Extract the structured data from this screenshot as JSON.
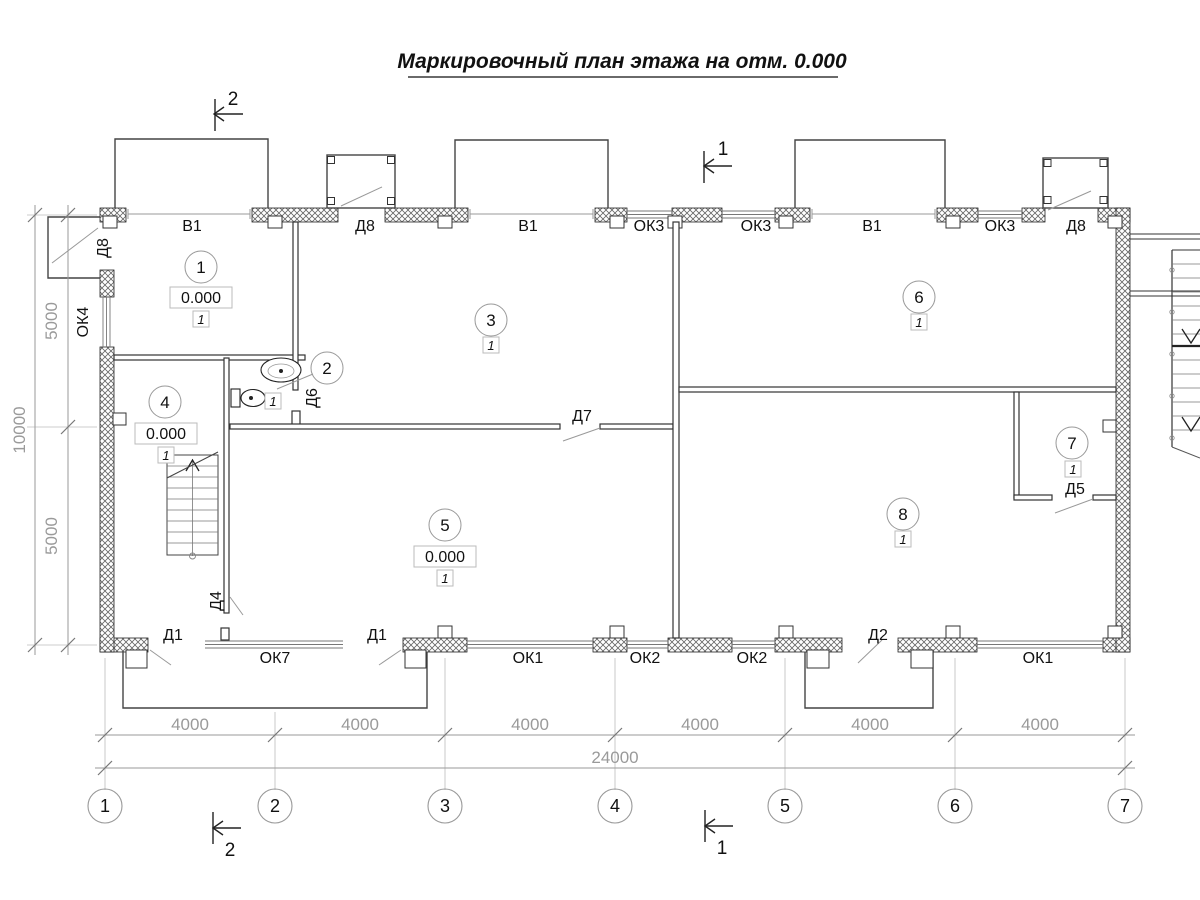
{
  "title": "Маркировочный план этажа на отм. 0.000",
  "axis_circles": [
    "1",
    "2",
    "3",
    "4",
    "5",
    "6",
    "7"
  ],
  "dims_bottom": {
    "segments": [
      "4000",
      "4000",
      "4000",
      "4000",
      "4000",
      "4000"
    ],
    "total": "24000"
  },
  "dims_left": {
    "segments": [
      "5000",
      "5000"
    ],
    "total": "10000"
  },
  "section_marks": {
    "top_left": "2",
    "top_right": "1",
    "bottom_left": "2",
    "bottom_right": "1"
  },
  "top_wall_labels": [
    "В1",
    "Д8",
    "В1",
    "ОК3",
    "ОК3",
    "В1",
    "ОК3",
    "Д8"
  ],
  "bottom_wall_labels": [
    "Д1",
    "ОК7",
    "Д1",
    "ОК1",
    "ОК2",
    "ОК2",
    "Д2",
    "ОК1"
  ],
  "left_wall_labels": [
    "Д8",
    "ОК4"
  ],
  "door_labels": [
    "Д6",
    "Д7",
    "Д4",
    "Д5"
  ],
  "rooms": [
    {
      "number": "1",
      "type": "1",
      "elevation": "0.000"
    },
    {
      "number": "2",
      "type": "1"
    },
    {
      "number": "3",
      "type": "1"
    },
    {
      "number": "4",
      "type": "1",
      "elevation": "0.000"
    },
    {
      "number": "5",
      "type": "1",
      "elevation": "0.000"
    },
    {
      "number": "6",
      "type": "1"
    },
    {
      "number": "7",
      "type": "1"
    },
    {
      "number": "8",
      "type": "1"
    }
  ]
}
